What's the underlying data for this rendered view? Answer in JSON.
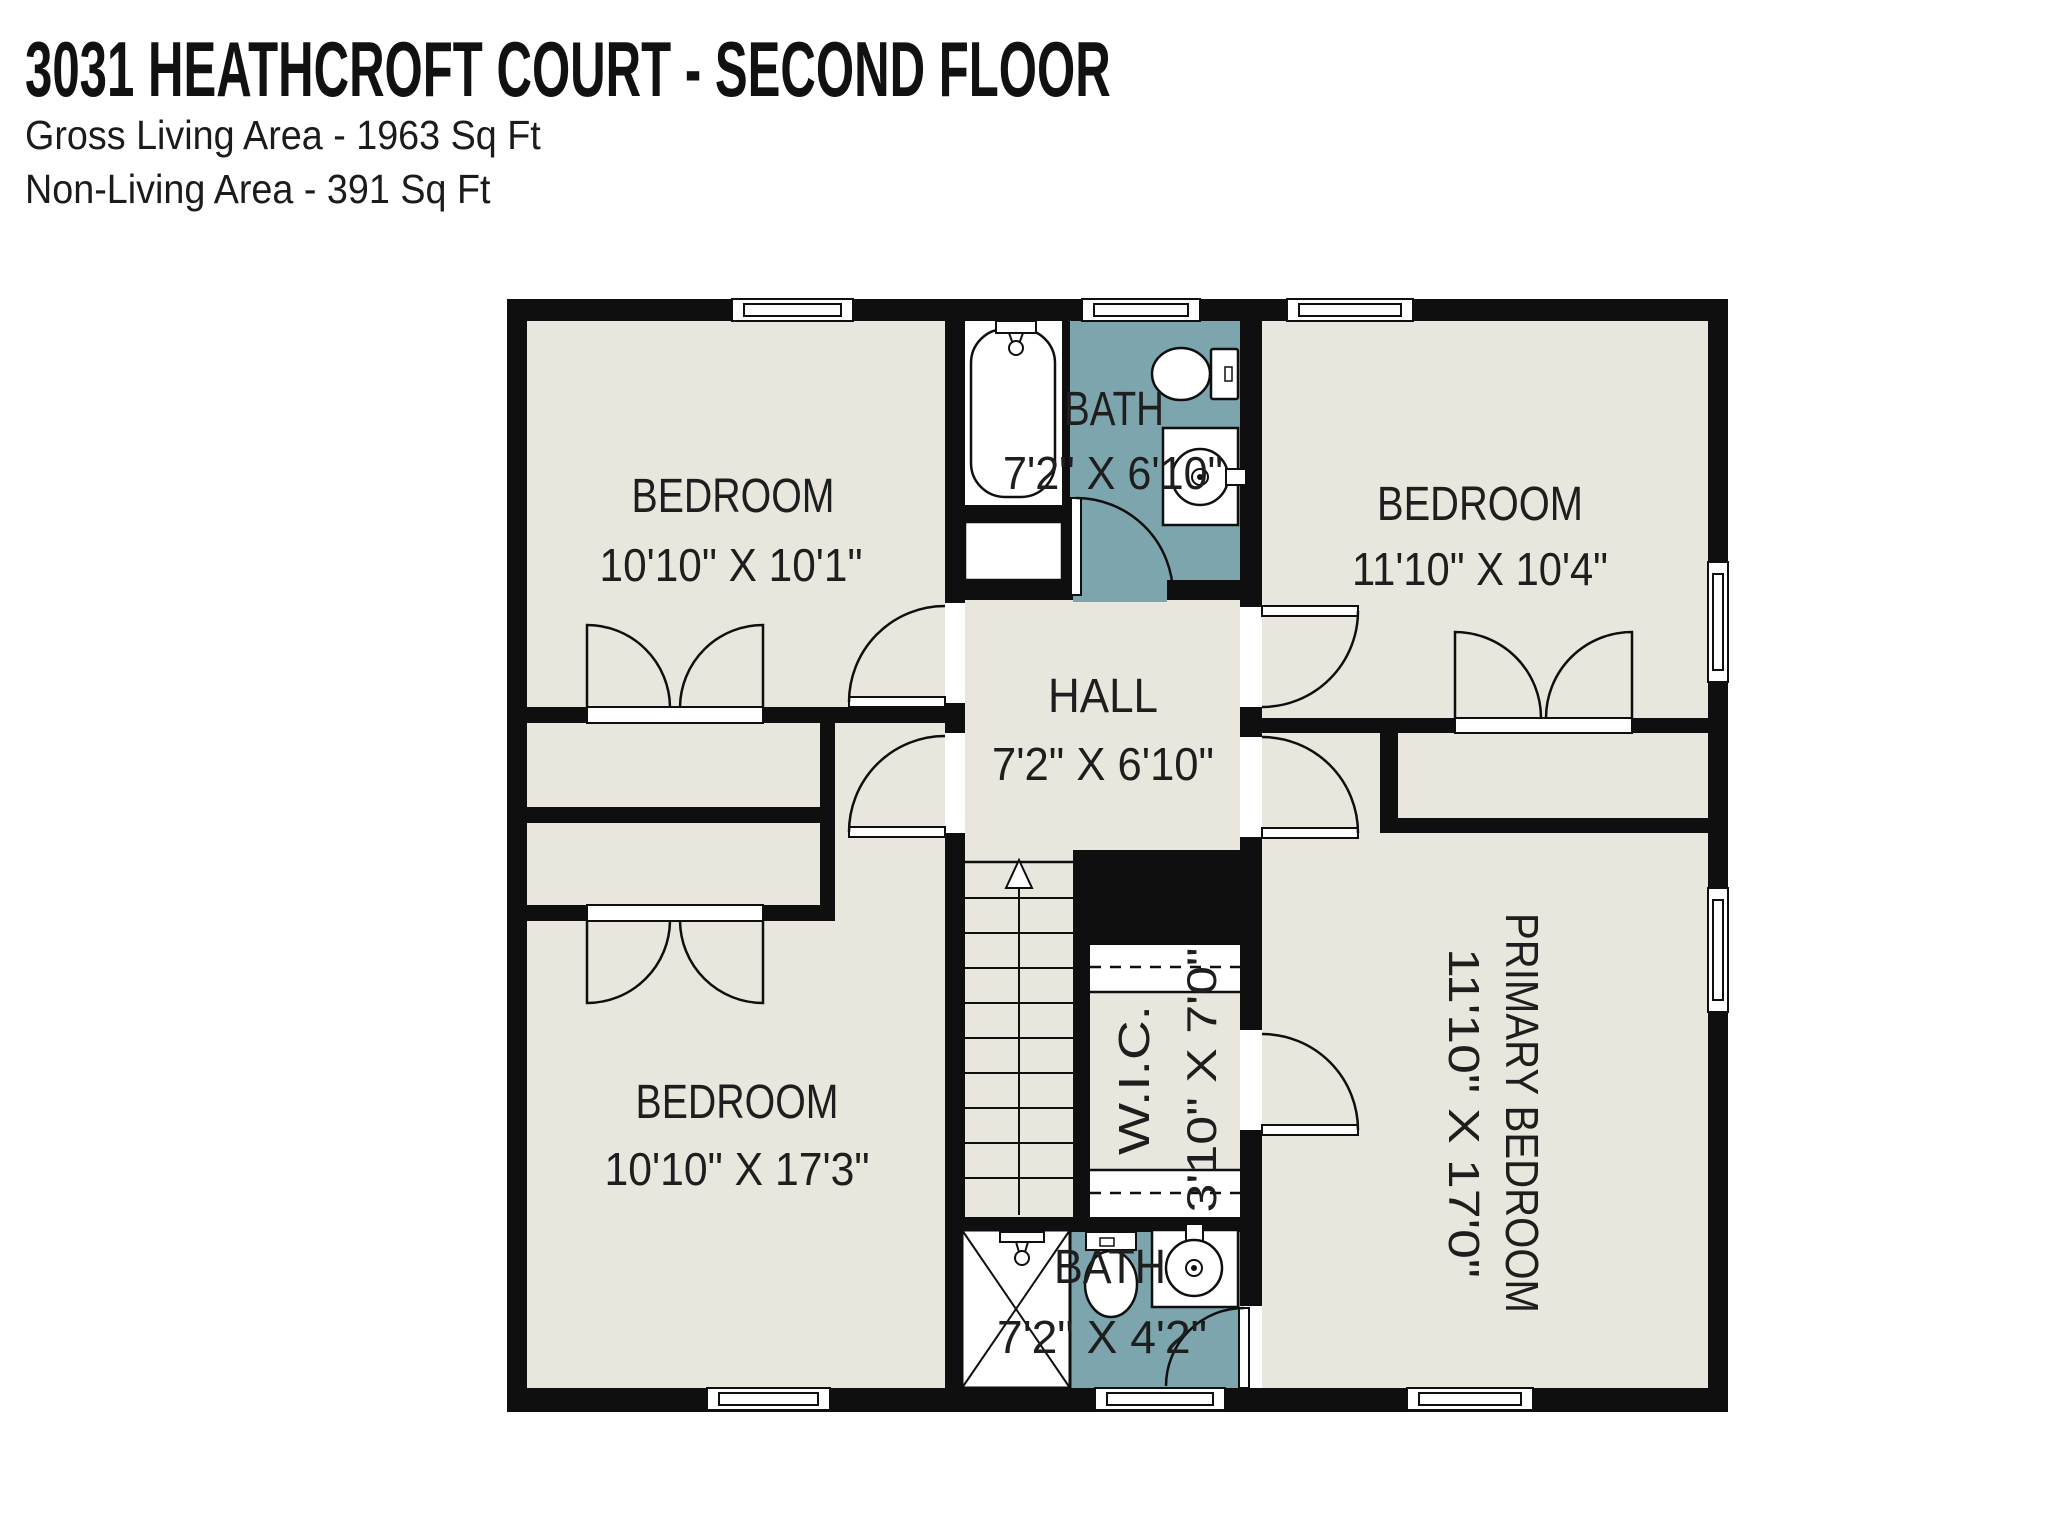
{
  "header": {
    "title": "3031 HEATHCROFT COURT - SECOND FLOOR",
    "gross_living_area": "Gross Living Area - 1963 Sq Ft",
    "non_living_area": "Non-Living Area - 391 Sq Ft"
  },
  "rooms": {
    "bedroom_top_left": {
      "name": "BEDROOM",
      "dims": "10'10\" X 10'1\""
    },
    "bath_top": {
      "name": "BATH",
      "dims": "7'2\" X 6'10\""
    },
    "bedroom_top_right": {
      "name": "BEDROOM",
      "dims": "11'10\" X 10'4\""
    },
    "hall": {
      "name": "HALL",
      "dims": "7'2\" X 6'10\""
    },
    "bedroom_bottom_left": {
      "name": "BEDROOM",
      "dims": "10'10\" X 17'3\""
    },
    "wic": {
      "name": "W.I.C.",
      "dims": "3'10\" X 7'0\""
    },
    "primary_bedroom": {
      "name": "PRIMARY BEDROOM",
      "dims": "11'10\" X 17'0\""
    },
    "bath_bottom": {
      "name": "BATH",
      "dims": "7'2\" X 4'2\""
    }
  },
  "colors": {
    "wall": "#0f0f0f",
    "floor_beige": "#e9e6dd",
    "bath_tile_teal": "#7da5ad",
    "fixture_white": "#ffffff",
    "label_text": "#1e1e1e"
  }
}
